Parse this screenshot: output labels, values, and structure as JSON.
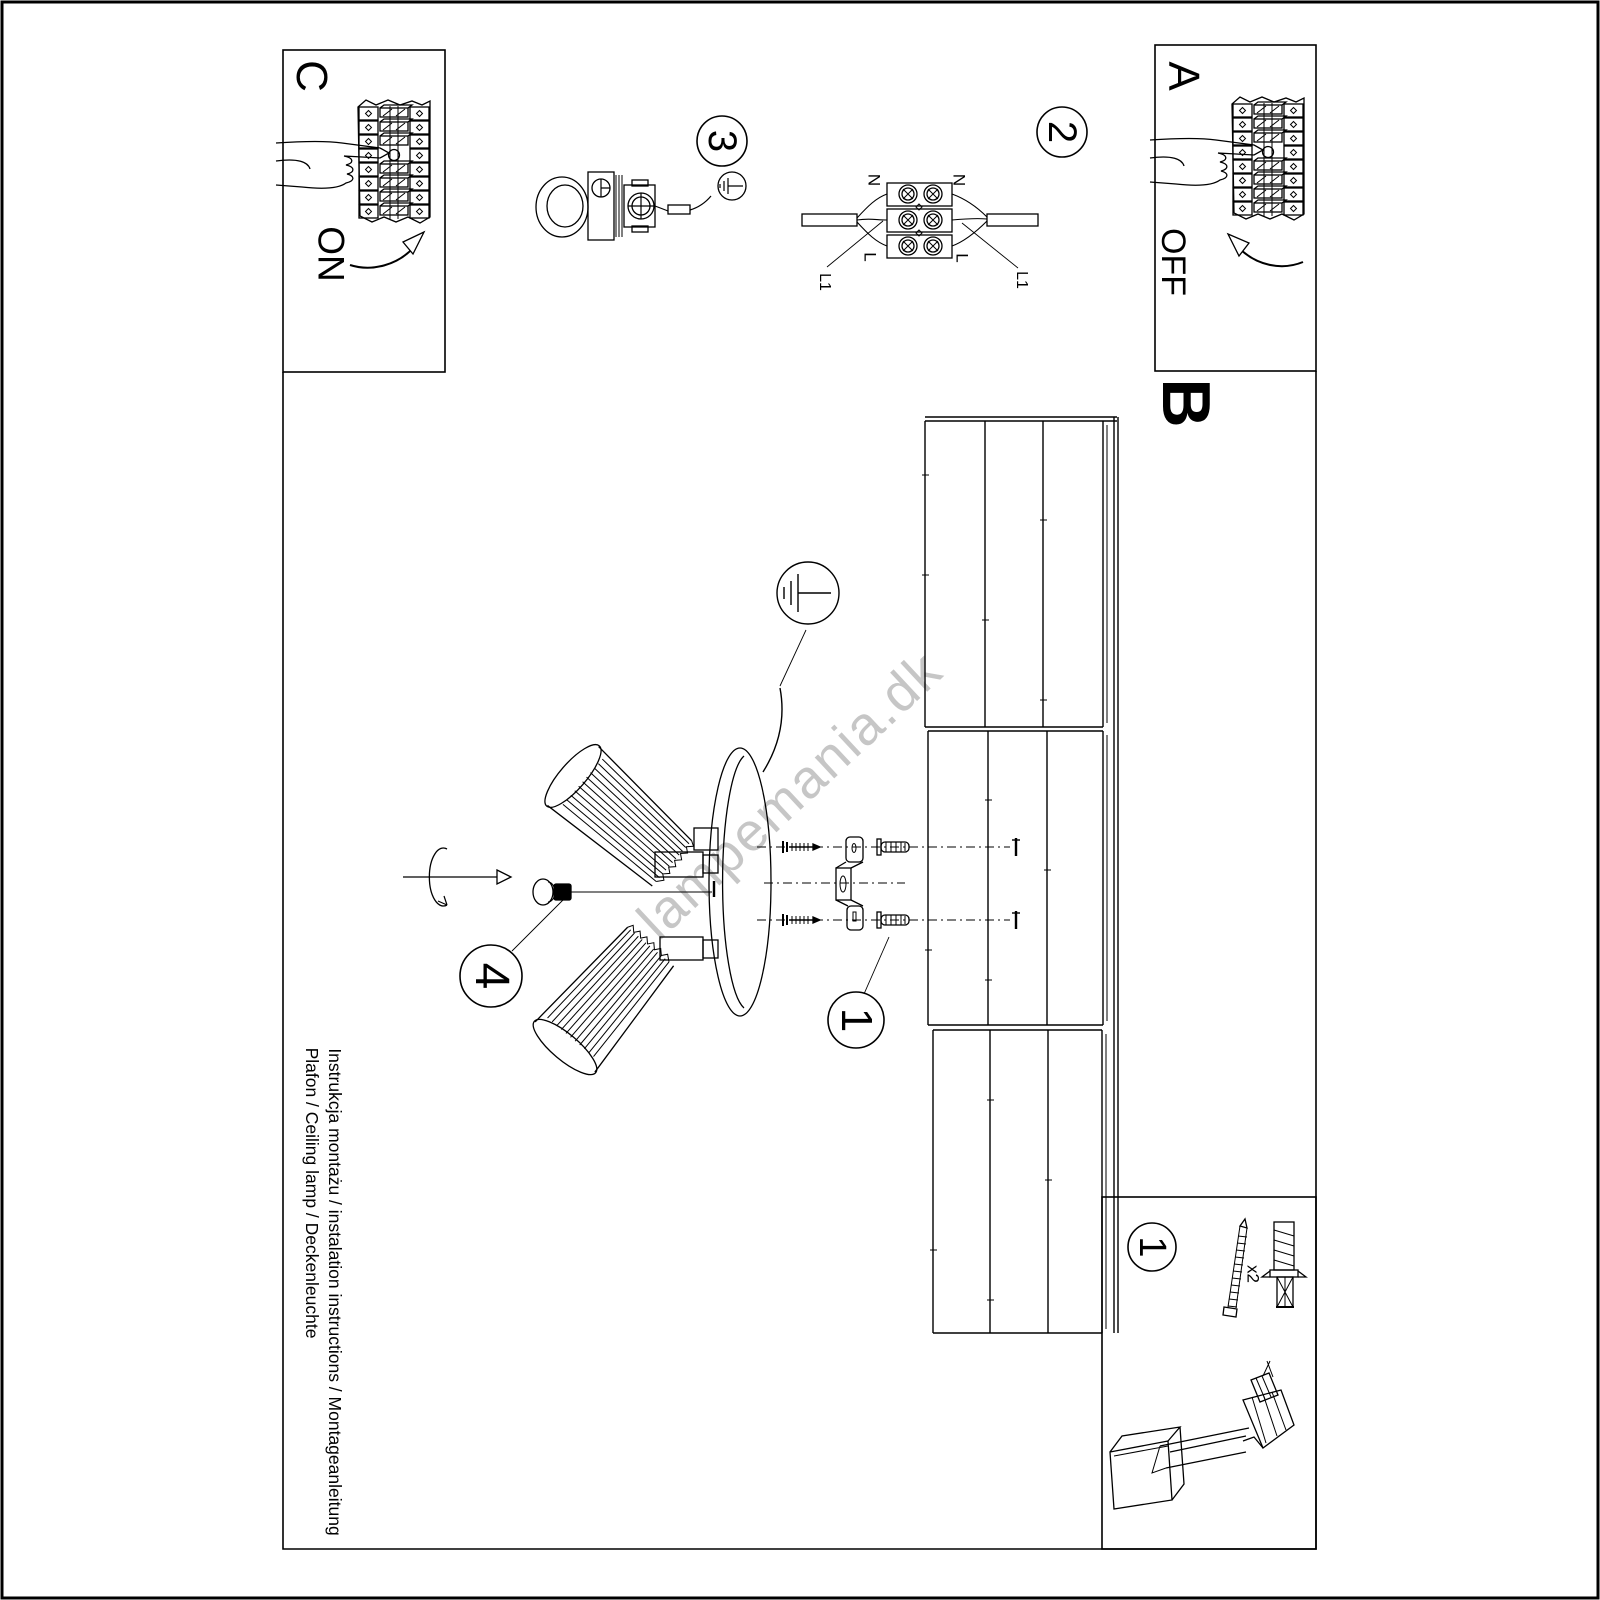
{
  "page": {
    "background": "#ffffff",
    "line_color": "#000000"
  },
  "corner_boxes": {
    "c": {
      "label": "C",
      "action": "ON"
    },
    "a": {
      "label": "A",
      "action": "OFF"
    }
  },
  "section_b_label": "B",
  "steps": {
    "step1": "1",
    "step2": "2",
    "step3": "3",
    "step4": "4",
    "accessories_step": "1"
  },
  "wiring": {
    "n_left": "N",
    "n_right": "N",
    "l_left": "L",
    "l_right": "L",
    "l1_left": "L1",
    "l1_right": "L1"
  },
  "accessories": {
    "quantity": "x2"
  },
  "footer": {
    "line1": "Instrukcja montażu / instalation instructions / Montageanleitung",
    "line2": "Plafon / Ceiling lamp / Deckenleuchte"
  },
  "watermark": {
    "text": "lampemania.dk",
    "color": "#c6c6c6"
  }
}
